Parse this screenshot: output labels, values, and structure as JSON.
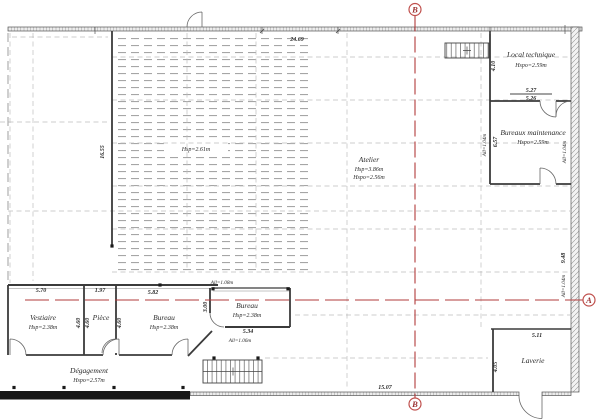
{
  "section_markers": {
    "top": "B",
    "bottom": "B",
    "right": "A"
  },
  "dims": {
    "top_width": "24.69",
    "left_height": "16.55",
    "bottom_width": "15.07",
    "right_height": "9.48",
    "laverie_width": "5.11",
    "laverie_height": "4.05",
    "lt_width_a": "5.27",
    "lt_width_b": "5.26",
    "lt_height": "4.10",
    "bm_height": "6.57",
    "vestiaire_width": "5.70",
    "piece_width": "1.97",
    "bureau1_width": "5.82",
    "bureau2_width": "5.34",
    "bureau2_height": "3.00",
    "vestiaire_height_dim": "4.60",
    "piece_height_dim_a": "4.60",
    "piece_height_dim_b": "4.60",
    "sill_top": "All=1.08m",
    "sill_bottom": "All=1.06m",
    "sill_bm_left": "All=1.04m",
    "sill_right_upper": "All=1.04m",
    "sill_right_lower": "All=1.04m"
  },
  "rooms": {
    "mezzanine": {
      "height": "Hsp=2.61m"
    },
    "atelier": {
      "name": "Atelier",
      "height_a": "Hsp=3.86m",
      "height_b": "Hspo=2.56m"
    },
    "local_technique": {
      "name": "Local technique",
      "height": "Hspo=2.59m"
    },
    "bureaux_maintenance": {
      "name": "Bureaux maintenance",
      "height": "Hspo=2.59m"
    },
    "laverie": {
      "name": "Laverie"
    },
    "vestiaire": {
      "name": "Vestiaire",
      "height": "Hsp=2.38m"
    },
    "piece": {
      "name": "Pièce"
    },
    "bureau1": {
      "name": "Bureau",
      "height": "Hsp=2.38m"
    },
    "bureau2": {
      "name": "Bureau",
      "height": "Hsp=2.38m"
    },
    "degagement": {
      "name": "Dégagement",
      "height": "Hspo=2.57m"
    }
  },
  "colors": {
    "section_red": "#b23b3b",
    "wall": "#3b3b3b"
  }
}
